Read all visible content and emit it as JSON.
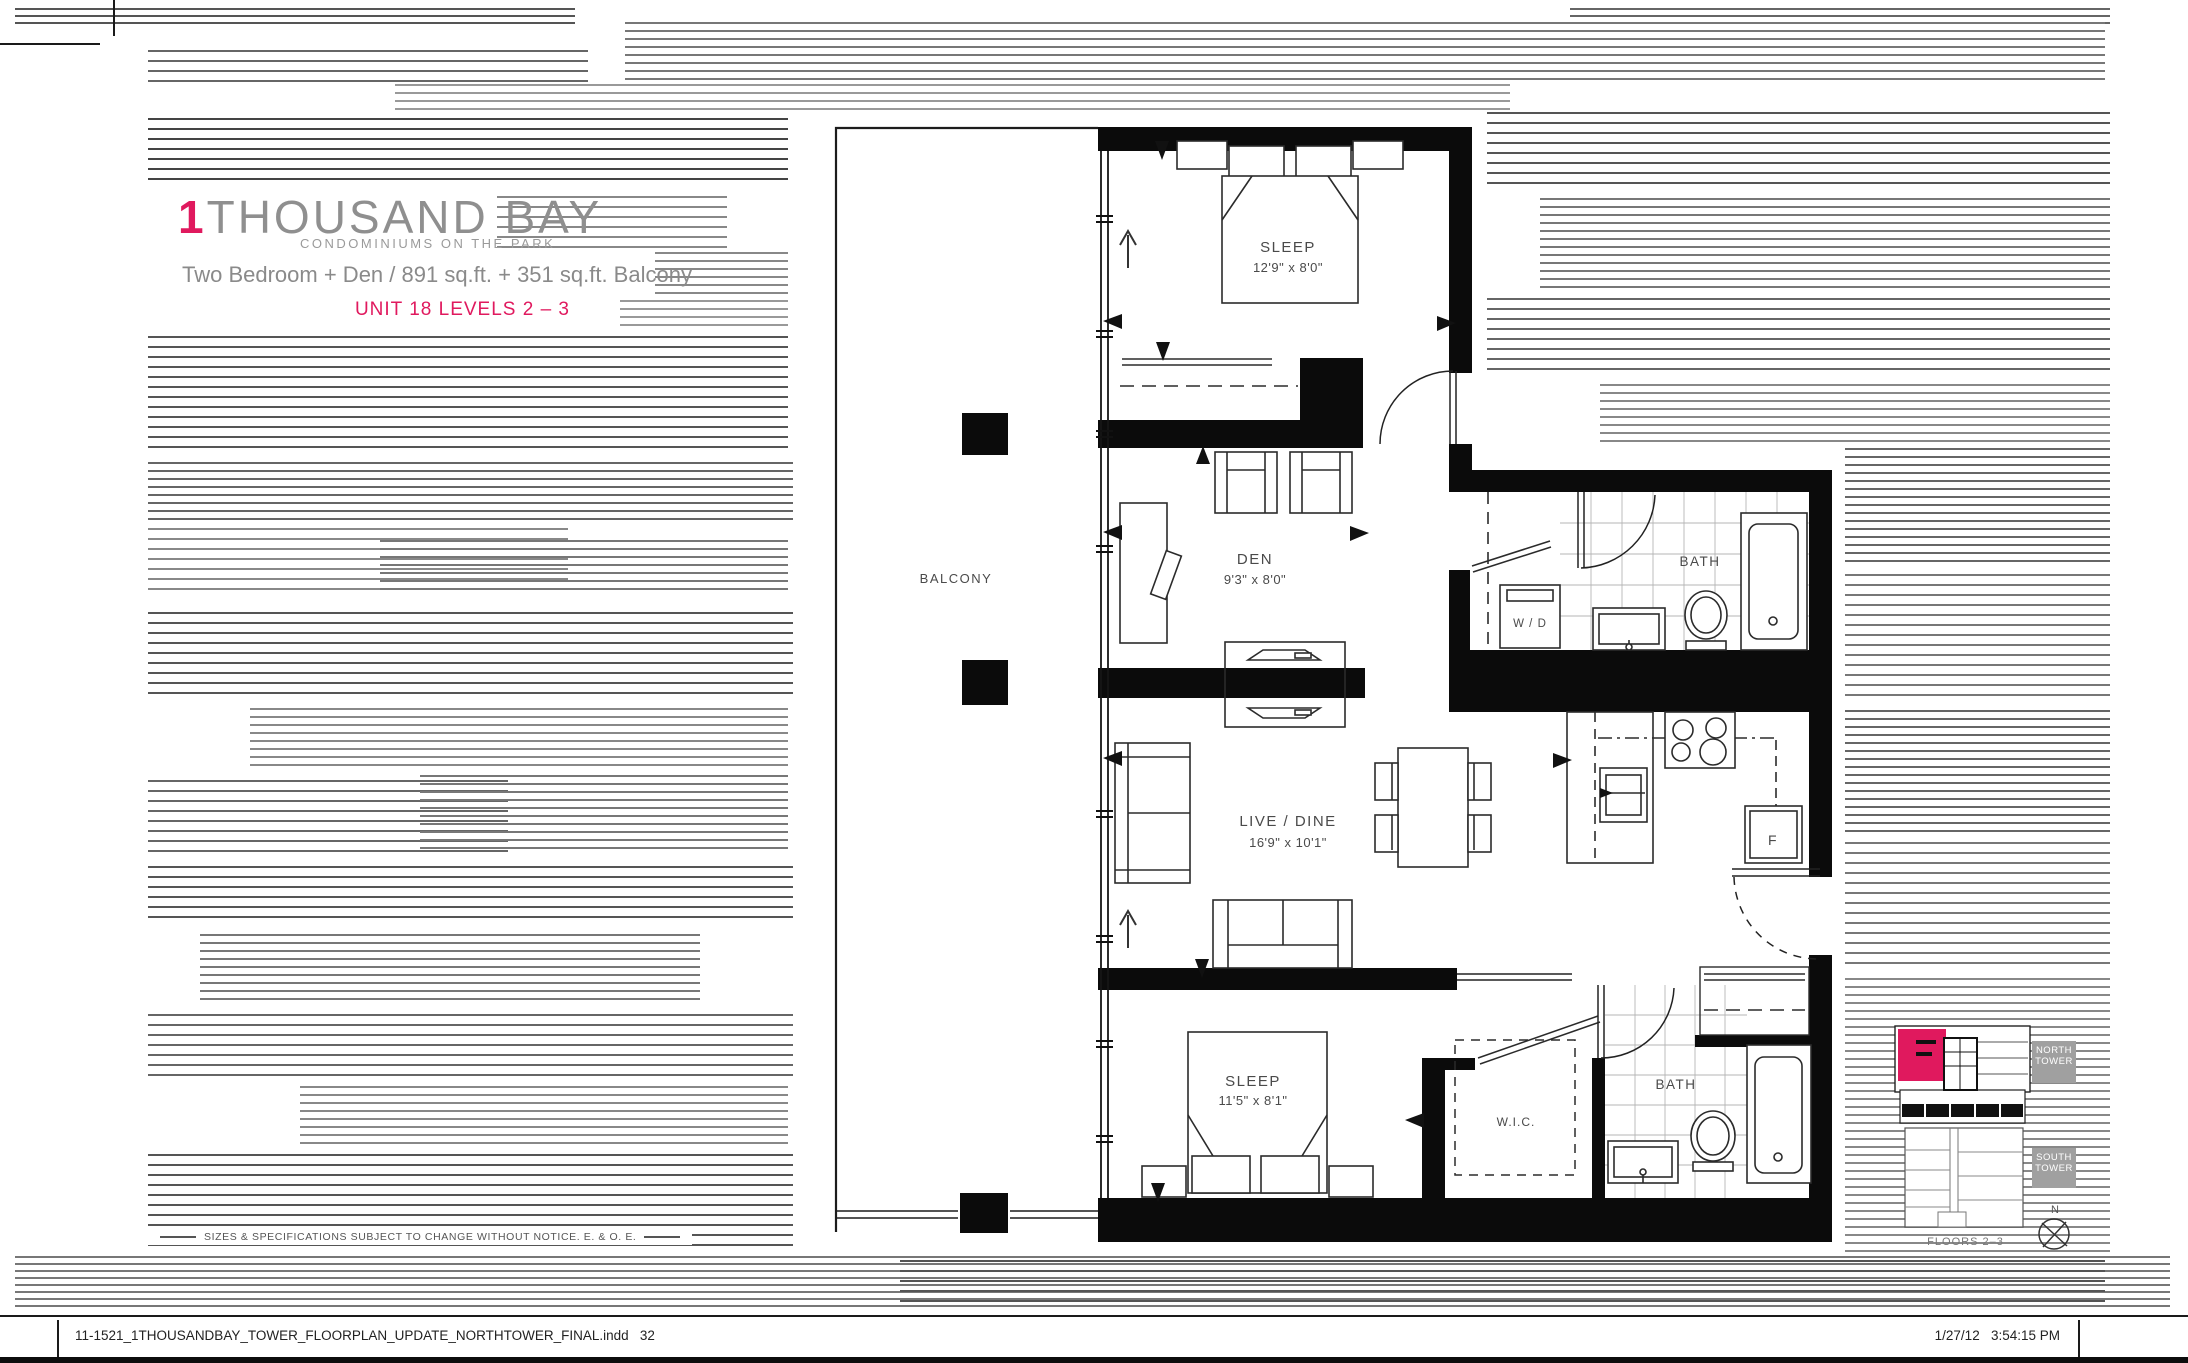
{
  "header": {
    "number": "1",
    "name": "THOUSAND BAY",
    "tagline": "CONDOMINIUMS ON THE PARK",
    "description": "Two Bedroom + Den / 891 sq.ft. + 351 sq.ft. Balcony",
    "unit": "UNIT 18 LEVELS 2 – 3"
  },
  "plan": {
    "rooms": {
      "sleep1": {
        "name": "SLEEP",
        "dims": "12'9\" x 8'0\""
      },
      "den": {
        "name": "DEN",
        "dims": "9'3\" x 8'0\""
      },
      "bath1": {
        "name": "BATH"
      },
      "wd": {
        "name": "W / D"
      },
      "livedine": {
        "name": "LIVE / DINE",
        "dims": "16'9\" x 10'1\""
      },
      "sleep2": {
        "name": "SLEEP",
        "dims": "11'5\" x 8'1\""
      },
      "wic": {
        "name": "W.I.C."
      },
      "bath2": {
        "name": "BATH"
      },
      "balcony": {
        "name": "BALCONY"
      },
      "fridge": {
        "name": "F"
      }
    }
  },
  "keyplan": {
    "north": "NORTH TOWER",
    "south": "SOUTH TOWER",
    "floors": "FLOORS 2–3",
    "compass_n": "N"
  },
  "disclaimer": {
    "text": "SIZES & SPECIFICATIONS SUBJECT TO CHANGE WITHOUT NOTICE. E. & O. E."
  },
  "footer": {
    "left": "11-1521_1THOUSANDBAY_TOWER_FLOORPLAN_UPDATE_NORTHTOWER_FINAL.indd   32",
    "right": "1/27/12   3:54:15 PM"
  },
  "colors": {
    "accent": "#e0195e",
    "wall": "#0b0b0b"
  }
}
